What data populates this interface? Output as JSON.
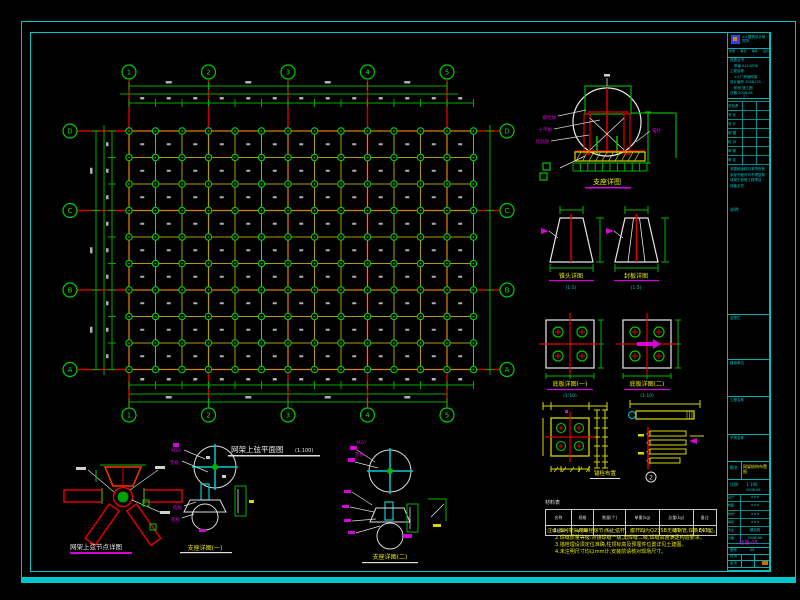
{
  "sheet": {
    "bg": "#000000",
    "frame_color": "#00c8c8"
  },
  "plan": {
    "origin_x": 129,
    "origin_y": 131,
    "cols": 14,
    "rows": 10,
    "step": 26.5,
    "axis_cols": [
      0,
      3,
      6,
      9,
      12
    ],
    "axis_rows": [
      0,
      3,
      6,
      9
    ],
    "col_axis_labels": [
      "1",
      "2",
      "3",
      "4",
      "5"
    ],
    "row_axis_labels": [
      "D",
      "C",
      "B",
      "A"
    ],
    "grid_color": "#b09c00",
    "node_color": "#00dd00",
    "axis_color": "#cc0000",
    "dim_color": "#00aa00",
    "title": "网架上弦平面图",
    "title_scale": "(1:100)"
  },
  "details": {
    "support_elev": {
      "title": "支座详图",
      "leaders": [
        "螺栓球",
        "十字板",
        "加劲肋",
        "锚栓"
      ]
    },
    "cone_left": {
      "title": "锥头详图",
      "scale": "(1:5)"
    },
    "cone_right": {
      "title": "封板详图",
      "scale": "(1:5)"
    },
    "plate_left": {
      "title": "底板详图(一)",
      "scale": "(1:10)"
    },
    "plate_right": {
      "title": "底板详图(二)",
      "scale": "(1:10)"
    },
    "anchor_plan": {
      "title": "锚栓布置"
    },
    "anchor_elev": {
      "circle": "2"
    },
    "node_detail": {
      "title": "网架上弦节点详图"
    },
    "support1": {
      "title": "支座详图(一)",
      "leaders": [
        "M20",
        "垫板"
      ],
      "leaders2": [
        "肋板",
        "底板"
      ]
    },
    "support2": {
      "title": "支座详图(二)",
      "leaders": [
        "M20",
        "垫板"
      ]
    }
  },
  "material_table": {
    "title": "材料表",
    "headers": [
      "名称",
      "规格",
      "数量(个)",
      "单重(kg)",
      "总重(kg)",
      "备注"
    ],
    "rows": [
      [
        "螺栓球",
        "φ100",
        "96",
        "3.2",
        "307",
        "Q235"
      ]
    ]
  },
  "notes": [
    "注:1.本网架采用螺栓球节点,上弦杆、腹杆均为Q235B无缝钢管,焊条E43型。",
    "2.焊缝质量等级:对接焊缝一级,角焊缝二级,焊缝高度满足构造要求。",
    "3.锚栓埋设须定位准确,柱顶标高及预埋件位置详见土建图。",
    "4.未注明尺寸均以mm计,安装前请核对现场尺寸。"
  ],
  "title_block": {
    "company": "××建筑设计研究院",
    "cert_row": [
      "批准",
      "审定",
      "审核",
      "设计"
    ],
    "info_lines": [
      "资质证书",
      "甲级 A113008",
      "工程名称",
      "××厂房钢网架",
      "设计编号 2008-J15",
      "阶段 施工图",
      "日期 2008.06"
    ],
    "divider_mark": "∕│∖",
    "sign_table": [
      "总负责",
      "专 业",
      "设 计",
      "制 图",
      "校 对",
      "审 核",
      "审 定"
    ],
    "copyright_lines": [
      "本图纸版权归本院所有",
      "未经书面许可不得复制",
      "或用于其他工程项目",
      "违者必究"
    ],
    "note_label": "说明:",
    "sections": [
      {
        "label": "会签栏"
      },
      {
        "label": "建设单位"
      },
      {
        "label": "工程名称"
      },
      {
        "label": "子项名称"
      }
    ],
    "drawing_name_label": "图名",
    "drawing_name": "网架结构布置图",
    "scale_label": "比例",
    "scale_value": "1:100",
    "date_value": "2008.06",
    "small_rows": [
      [
        "设计",
        "×××"
      ],
      [
        "制图",
        "×××"
      ],
      [
        "校对",
        "×××"
      ],
      [
        "审核",
        "×××"
      ],
      [
        "专业",
        "钢结构"
      ],
      [
        "日期",
        "2008.06"
      ]
    ],
    "drawing_no": "结施-08",
    "drawing_no_label": "图号",
    "sheet_no": "08",
    "bottom_cells": [
      "共 张",
      "第 张"
    ]
  }
}
